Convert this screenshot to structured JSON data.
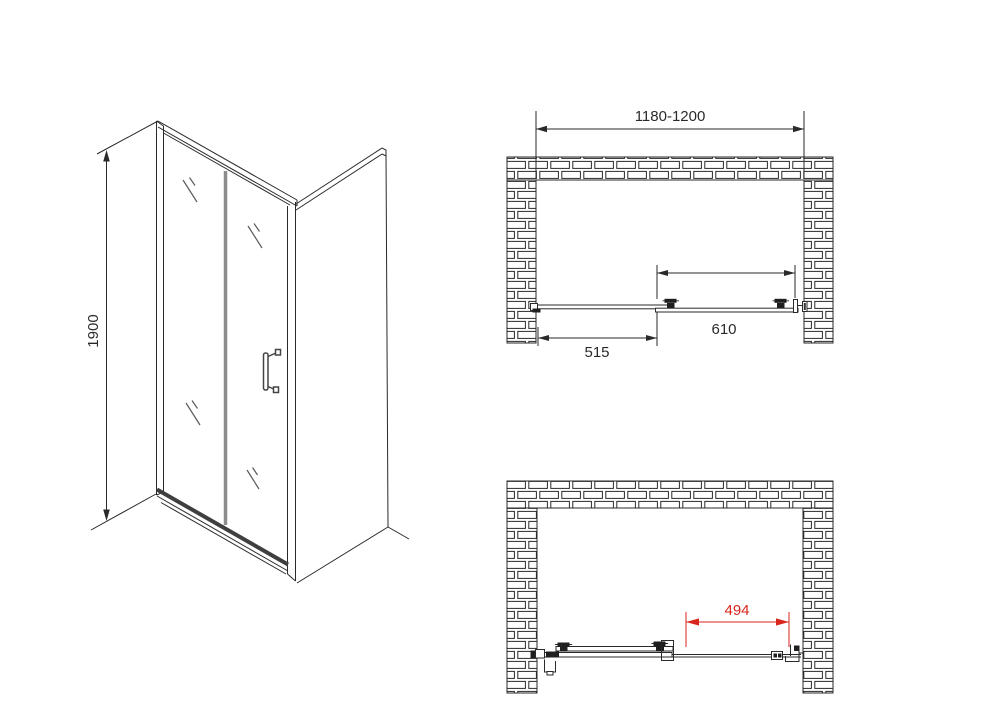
{
  "colors": {
    "line": "#2a2a2a",
    "accent_red": "#d9261c",
    "glass_divider": "#8c8c8c",
    "hardware_dark": "#1f1f1f"
  },
  "isometric": {
    "height_dim": "1900"
  },
  "plan_closed": {
    "opening_width_dim": "1180-1200",
    "fixed_panel_dim": "515",
    "sliding_panel_dim": "610"
  },
  "plan_open": {
    "clear_opening_dim": "494"
  }
}
